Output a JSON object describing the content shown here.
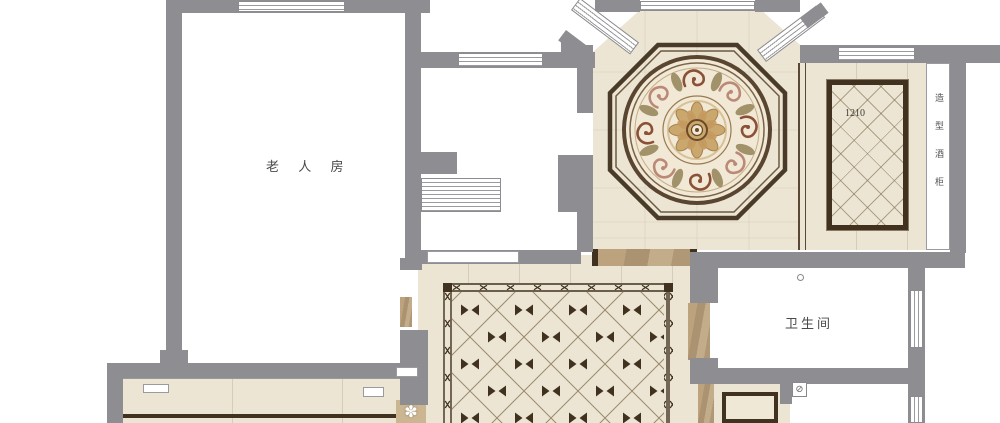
{
  "plan_type": "residential floor plan - tile layout",
  "labels": {
    "elder_room": "老 人 房",
    "bathroom": "卫生间",
    "panel_size": "1210",
    "wine_cabinet": "造型酒柜"
  },
  "symbols": {
    "flower": "✽",
    "drain": "⊘"
  },
  "colors": {
    "wall": "#8d8d92",
    "tile": "#ece5d3",
    "joint": "#d6cdb8",
    "border_dark": "#41311f",
    "travertine": "#b39c78",
    "accent_brown": "#8a5138",
    "accent_rose": "#bb8977",
    "accent_olive": "#8f7c4f",
    "accent_gold": "#c9a76d",
    "label_text": "#4a4a4a"
  }
}
